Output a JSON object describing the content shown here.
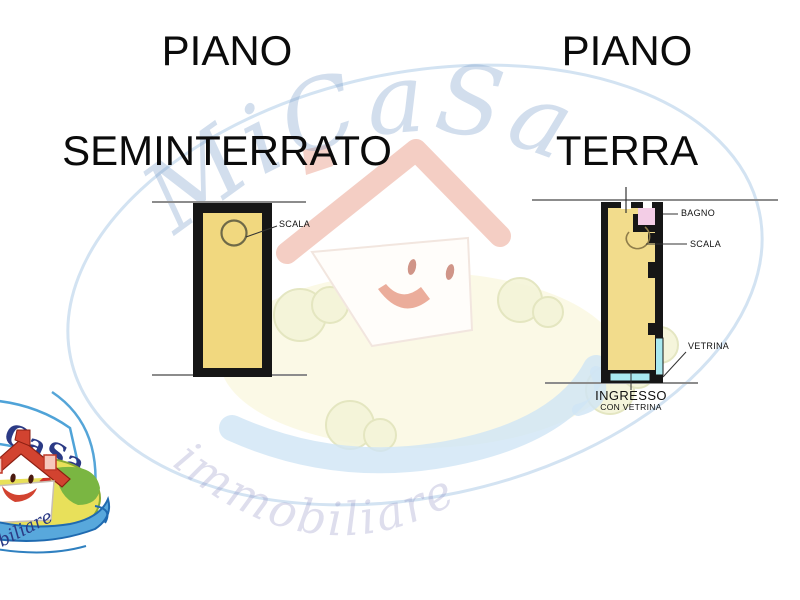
{
  "titles": {
    "left": {
      "line1": "PIANO",
      "line2": "SEMINTERRATO"
    },
    "right": {
      "line1": "PIANO",
      "line2": "TERRA"
    }
  },
  "plan_seminterrato": {
    "scala_label": "SCALA"
  },
  "plan_terra": {
    "bagno_label": "BAGNO",
    "scala_label": "SCALA",
    "vetrina_label": "VETRINA",
    "ingresso_label": "INGRESSO",
    "ingresso_sub_label": "CON VETRINA"
  },
  "watermark": {
    "brand": "MiCaSa",
    "tagline": "immobiliare"
  },
  "corner_logo": {
    "brand_visible": "CaSa",
    "tagline_visible": "obiliare"
  },
  "colors": {
    "room_fill_left": "#f1d87f",
    "room_fill_right": "#f2dc8c",
    "bagno_fill": "#f3cde6",
    "vetrina_fill": "#a9e9ef",
    "wall": "#161616",
    "boundary_line": "#8c8c8c",
    "leader_line": "#333333",
    "title_text": "#0b0b0b",
    "watermark_blue": "#7e9fc9",
    "logo_blue": "#2b3a85",
    "logo_red": "#d24330",
    "logo_green": "#7ab642",
    "logo_yellow": "#e8e05a"
  }
}
